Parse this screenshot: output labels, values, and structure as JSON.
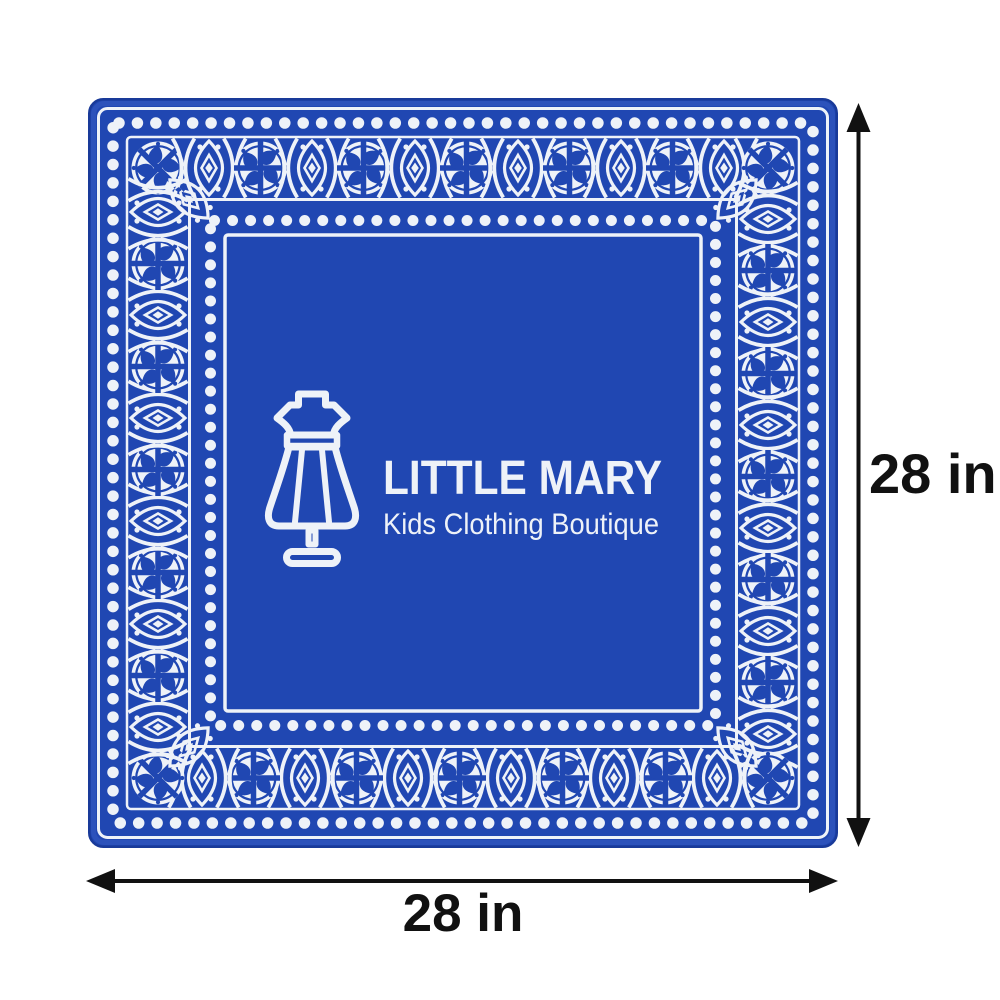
{
  "page": {
    "background": "#ffffff"
  },
  "bandana": {
    "kind": "square bandana / scarf print mockup",
    "colors": {
      "blue": "#2047b2",
      "white": "#eef2f8",
      "edge": "#193a99",
      "ink": "#111111",
      "bg": "#ffffff"
    },
    "border_pattern": {
      "motifs": [
        "wheel-medallion",
        "diamond-eye",
        "crossed-arc-chevron",
        "dot-row"
      ],
      "dot_rows": 2,
      "frame_lines": 4,
      "corner_ornaments": [
        "rotated-wheel-medallion",
        "diagonal-diamond-eye"
      ]
    },
    "logo": {
      "brand_name": "LITTLE MARY",
      "tagline": "Kids Clothing Boutique",
      "icon": "dress-form-mannequin-icon"
    }
  },
  "dimensions": {
    "width_label": "28 in",
    "height_label": "28 in"
  }
}
